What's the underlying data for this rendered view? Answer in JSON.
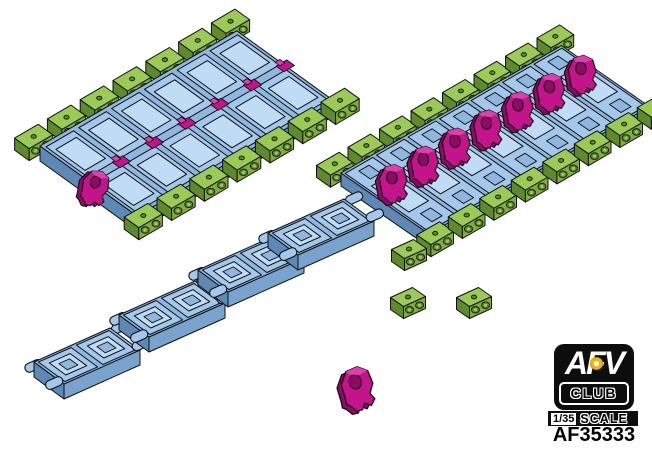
{
  "branding": {
    "logo_top": "AFV",
    "logo_bottom": "CLUB",
    "scale_fraction": "1/35",
    "scale_word": "SCALE",
    "product_code": "AF35333",
    "logo_bg": "#0d0d0d",
    "logo_dot_color": "#F2B705"
  },
  "illustration": {
    "background": "#ffffff",
    "colors": {
      "outline": "#101010",
      "blue_top": "#A3C8EC",
      "blue_light": "#BFDBF5",
      "blue_mid": "#8FB6DE",
      "blue_side": "#79A3CF",
      "blue_dark": "#5E88B5",
      "green_top": "#9CCB55",
      "green_side": "#7FAE3C",
      "green_dark": "#5F8A2C",
      "magenta": "#C5138C",
      "magenta_dark": "#8E0A64",
      "magenta_light": "#DE3FAD"
    },
    "runs": {
      "outer": {
        "name": "assembled track run, pad side up",
        "links": 6,
        "pads_across": 2,
        "connectors_per_side": 7,
        "center_guides": 6,
        "loose_horns": 1
      },
      "inner": {
        "name": "assembled track run, guide horns up",
        "links": 7,
        "pads_across": 2,
        "connectors_per_side": 8,
        "guide_horns": 7
      }
    },
    "loose": {
      "segments": 4,
      "end_connectors": 3,
      "guide_horns": 1
    }
  }
}
